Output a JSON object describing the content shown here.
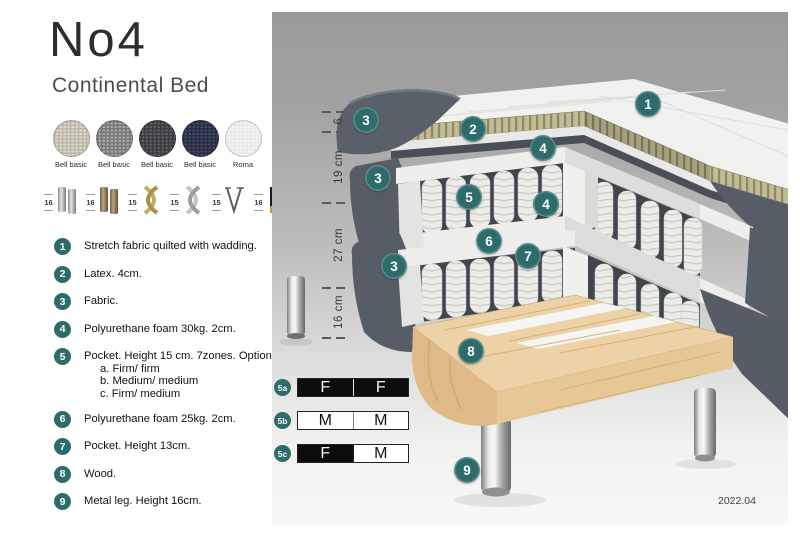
{
  "header": {
    "title": "No4",
    "subtitle": "Continental Bed"
  },
  "fabric_swatches": [
    {
      "line1": "Bell basic",
      "line2": "MCD36",
      "color1": "#dcd8cd",
      "color2": "#bdb8aa"
    },
    {
      "line1": "Bell basic",
      "line2": "MCD32",
      "color1": "#a8a8a5",
      "color2": "#77777a"
    },
    {
      "line1": "Bell basic",
      "line2": "MCD43",
      "color1": "#5d5e62",
      "color2": "#3b3c3f"
    },
    {
      "line1": "Bell basic",
      "line2": "MCD74",
      "color1": "#444a66",
      "color2": "#282c40"
    },
    {
      "line1": "Roma",
      "line2": "stretch fabric",
      "color1": "#f5f5f4",
      "color2": "#e9e9e7"
    }
  ],
  "leg_options": [
    {
      "height": "16",
      "type": "cyl-silver"
    },
    {
      "height": "16",
      "type": "cyl-bronze"
    },
    {
      "height": "15",
      "type": "cross-gold"
    },
    {
      "height": "15",
      "type": "cross-silver"
    },
    {
      "height": "15",
      "type": "hairpin"
    },
    {
      "height": "16",
      "type": "taper-black-gold"
    }
  ],
  "legend": [
    {
      "num": "1",
      "text": "Stretch fabric quilted with wadding."
    },
    {
      "num": "2",
      "text": "Latex. 4cm."
    },
    {
      "num": "3",
      "text": "Fabric."
    },
    {
      "num": "4",
      "text": "Polyurethane foam 30kg. 2cm."
    },
    {
      "num": "5",
      "text": "Pocket. Height 15 cm. 7zones. Option:",
      "options": [
        "a. Firm/ firm",
        "b. Medium/ medium",
        "c. Firm/ medium"
      ]
    },
    {
      "num": "6",
      "text": "Polyurethane foam 25kg. 2cm."
    },
    {
      "num": "7",
      "text": "Pocket. Height 13cm."
    },
    {
      "num": "8",
      "text": "Wood."
    },
    {
      "num": "9",
      "text": "Metal leg. Height 16cm."
    }
  ],
  "diagram": {
    "dimension_labels": [
      {
        "label": "6",
        "y_top": 111,
        "y_bottom": 131
      },
      {
        "label": "19 cm",
        "y_top": 131,
        "y_bottom": 202
      },
      {
        "label": "27 cm",
        "y_top": 202,
        "y_bottom": 287
      },
      {
        "label": "16 cm",
        "y_top": 287,
        "y_bottom": 337
      }
    ],
    "markers": [
      {
        "num": "1",
        "x": 648,
        "y": 104
      },
      {
        "num": "2",
        "x": 473,
        "y": 129
      },
      {
        "num": "3",
        "x": 366,
        "y": 120
      },
      {
        "num": "3",
        "x": 378,
        "y": 178
      },
      {
        "num": "3",
        "x": 394,
        "y": 266
      },
      {
        "num": "4",
        "x": 543,
        "y": 148
      },
      {
        "num": "4",
        "x": 546,
        "y": 204
      },
      {
        "num": "5",
        "x": 469,
        "y": 197
      },
      {
        "num": "6",
        "x": 489,
        "y": 241
      },
      {
        "num": "7",
        "x": 528,
        "y": 256
      },
      {
        "num": "8",
        "x": 471,
        "y": 351
      },
      {
        "num": "9",
        "x": 467,
        "y": 470
      }
    ]
  },
  "firmness_table": {
    "rows": [
      {
        "id": "5a",
        "cells": [
          {
            "letter": "F",
            "style": "dark"
          },
          {
            "letter": "F",
            "style": "dark"
          }
        ]
      },
      {
        "id": "5b",
        "cells": [
          {
            "letter": "M",
            "style": "light"
          },
          {
            "letter": "M",
            "style": "light"
          }
        ]
      },
      {
        "id": "5c",
        "cells": [
          {
            "letter": "F",
            "style": "dark"
          },
          {
            "letter": "M",
            "style": "light"
          }
        ]
      }
    ]
  },
  "footer": {
    "version": "2022.04"
  },
  "colors": {
    "accent_teal": "#2e6c6b",
    "panel_top": "#9a9a9a",
    "panel_bottom": "#f7f7f6",
    "cell_dark": "#0c0c0c",
    "cell_light": "#ffffff"
  }
}
